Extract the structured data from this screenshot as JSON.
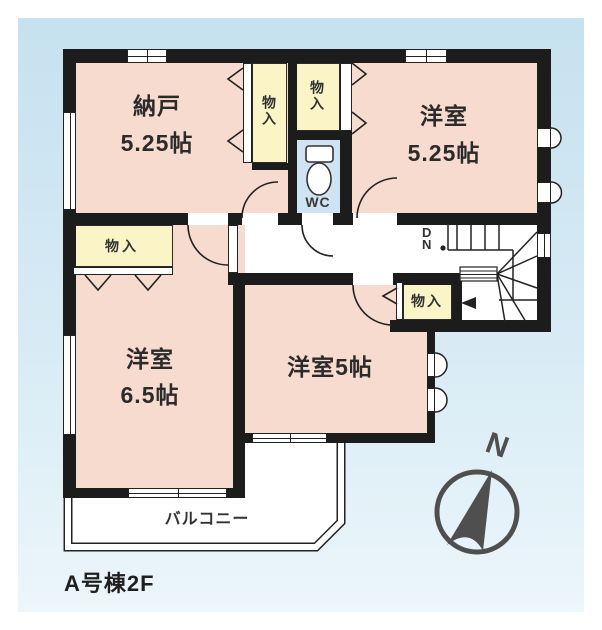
{
  "colors": {
    "background_blue_top": "#c6e1ef",
    "background_blue_bottom": "#ecf6fb",
    "wall": "#1c1c1c",
    "room_pink": "#f7dbce",
    "closet_yellow": "#fbf4c6",
    "wc_blue": "#cfe3f2",
    "compass_gray": "#4f4f4f"
  },
  "floor_label": "A号棟2F",
  "rooms": {
    "nando": {
      "name": "納戸",
      "size": "5.25帖"
    },
    "western_room_525": {
      "name": "洋室",
      "size": "5.25帖"
    },
    "western_room_65": {
      "name": "洋室",
      "size": "6.5帖"
    },
    "western_room_5": {
      "name": "洋室5帖"
    },
    "wc": {
      "name": "WC"
    },
    "balcony": {
      "name": "バルコニー"
    }
  },
  "closets": {
    "nando_closet": {
      "label": "物入"
    },
    "room525_closet": {
      "label": "物入"
    },
    "hall_closet": {
      "label": "物入"
    },
    "room65_closet": {
      "label": "物入"
    }
  },
  "stairs": {
    "direction_letter_1": "D",
    "direction_letter_2": "N"
  },
  "compass": {
    "north_label": "N"
  }
}
